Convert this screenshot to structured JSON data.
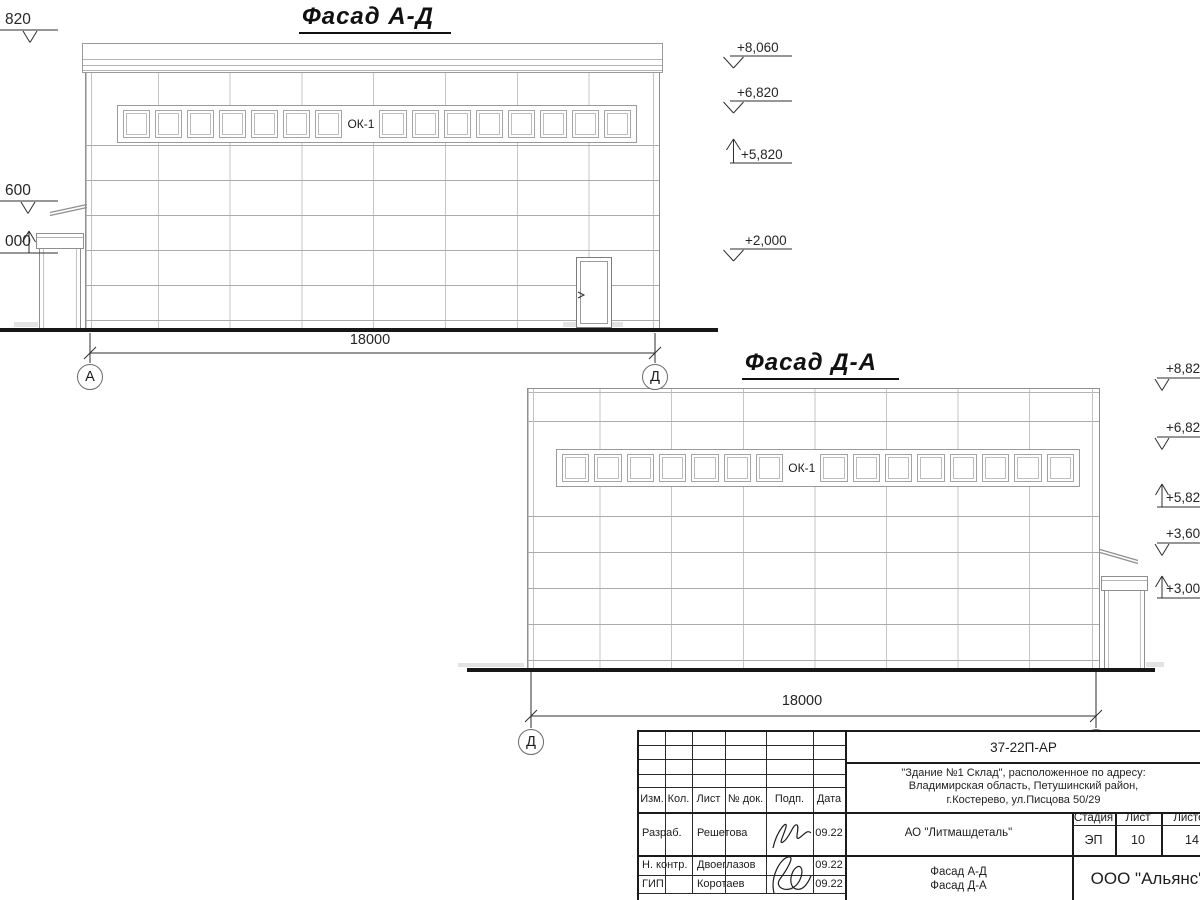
{
  "facade1": {
    "title": "Фасад А-Д",
    "window_label": "ОК-1",
    "dimension": "18000",
    "axis_left": "А",
    "axis_right": "Д",
    "marks_right": [
      "+8,060",
      "+6,820",
      "+5,820",
      "+2,000"
    ],
    "marks_left": [
      "820",
      "600",
      "000"
    ]
  },
  "facade2": {
    "title": "Фасад Д-А",
    "window_label": "ОК-1",
    "dimension": "18000",
    "axis_left": "Д",
    "axis_right": "А",
    "marks_right": [
      "+8,82",
      "+6,82",
      "+5,82",
      "+3,60",
      "+3,00"
    ]
  },
  "stamp": {
    "doc_number": "37-22П-АР",
    "address_lines": [
      "\"Здание №1 Склад\", расположенное по адресу:",
      "Владимирская область, Петушинский район,",
      "г.Костерево, ул.Писцова 50/29"
    ],
    "client": "АО \"Литмашдеталь\"",
    "sheet_titles": [
      "Фасад А-Д",
      "Фасад Д-А"
    ],
    "company": "ООО \"Альянс\"",
    "stage_label": "Стадия",
    "sheet_label": "Лист",
    "sheets_label": "Листов",
    "stage": "ЭП",
    "sheet_no": "10",
    "sheets_total": "14",
    "columns": [
      "Изм.",
      "Кол.",
      "Лист",
      "№ док.",
      "Подп.",
      "Дата"
    ],
    "signers": [
      {
        "role": "Разраб.",
        "name": "Решетова",
        "date": "09.22"
      },
      {
        "role": "Н. контр.",
        "name": "Двоеглазов",
        "date": "09.22"
      },
      {
        "role": "ГИП",
        "name": "Коротаев",
        "date": "09.22"
      }
    ]
  }
}
